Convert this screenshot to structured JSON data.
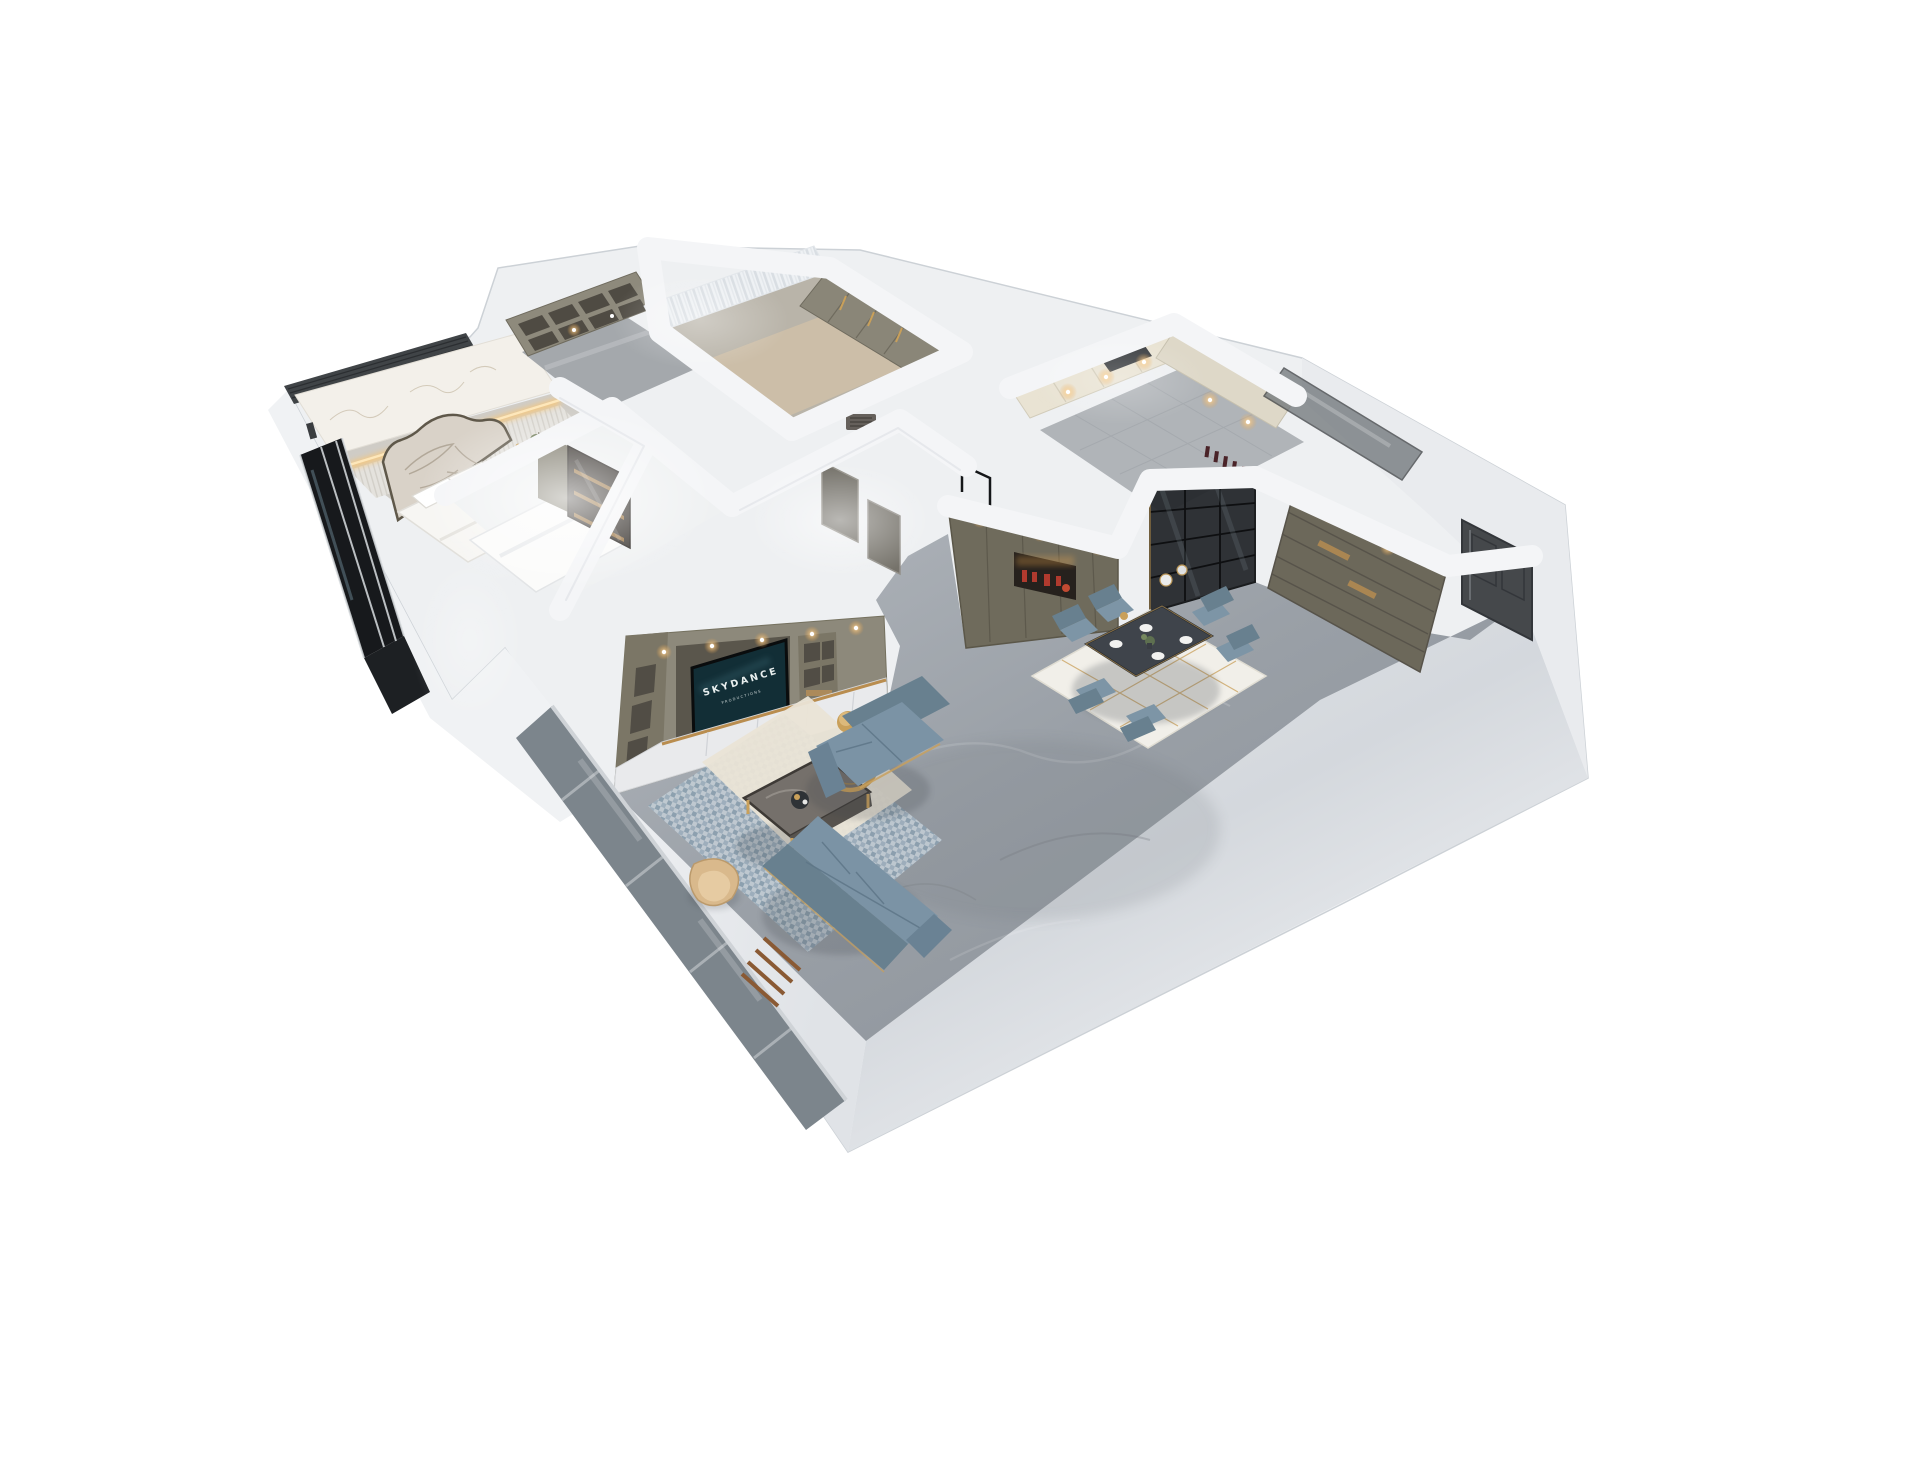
{
  "image": {
    "kind": "photorealistic 3d dollhouse floor-plan render",
    "view": "elevated three-quarter top-down, no ceiling",
    "background": "#ffffff"
  },
  "tv": {
    "line1": "SKYDANCE",
    "line2": "PRODUCTIONS"
  },
  "palette": {
    "wall_white": "#eef0f2",
    "wall_shadow": "#d9dde1",
    "floor_marble": "#9aa0a7",
    "floor_marble_light": "#b4b9bf",
    "cabinet_olive": "#6f6b5c",
    "cabinet_taupe": "#8d897b",
    "cabinet_cream": "#e8e2d4",
    "drawer_white": "#e9eaec",
    "sofa_blue": "#7b93a5",
    "chair_blue": "#7d95a6",
    "gold": "#c9a05a",
    "wood": "#b98d4f",
    "tv_screen": "#122e36",
    "entry_door_gray": "#45484b",
    "smoked_glass": "#24272b",
    "window_glass_black": "#17191c",
    "warm_light": "#e8a44c",
    "red_decor": "#b03a2e",
    "bed_cream": "#d9d2c8",
    "curtain_white": "#eef1f4",
    "rug_cream": "#eae4d6",
    "rug_blue": "#b3bfca",
    "rug_dining_white": "#f1efe9"
  },
  "rooms": [
    {
      "name": "master-bedroom",
      "furniture": [
        "upholstered-bed",
        "quilted-headboard",
        "pillows",
        "nightstand",
        "plant",
        "marble-feature-wall",
        "led-cove-light",
        "ribbed-panel",
        "black-glazed-windows",
        "louver-band"
      ]
    },
    {
      "name": "walk-in-closet",
      "furniture": [
        "cube-shelf-unit",
        "downlights"
      ]
    },
    {
      "name": "dressing-bath-room",
      "furniture": [
        "sheer-curtains",
        "wardrobe-gold-handles",
        "floor-mat",
        "shower-drain"
      ]
    },
    {
      "name": "kitchen",
      "furniture": [
        "cream-cabinets",
        "range-hood",
        "counter",
        "wine-bottles",
        "mirror-wall",
        "downlights"
      ]
    },
    {
      "name": "dining-area",
      "furniture": [
        "dark-marble-dining-table",
        "six-blue-chairs",
        "gold-lined-rug",
        "plates",
        "centerpiece",
        "pendant-globes"
      ]
    },
    {
      "name": "hallway-entry",
      "furniture": [
        "olive-display-cabinet",
        "red-decor-niche",
        "smoked-glass-sliding-doors",
        "entry-storage-cabinet",
        "dark-entry-door"
      ]
    },
    {
      "name": "living-room",
      "furniture": [
        "tv-media-wall",
        "television",
        "white-drawer-base",
        "open-shelving",
        "loveseat-sofa",
        "long-sofa",
        "marble-coffee-table",
        "gold-ring-decor",
        "gold-stool",
        "beige-accent-chair",
        "patterned-rug",
        "cream-rug",
        "ladder-shelf",
        "window-wall"
      ]
    },
    {
      "name": "second-bedroom",
      "furniture": [
        "white-bed",
        "backlit-dark-wardrobe",
        "gray-doors",
        "black-frame-partition"
      ]
    }
  ]
}
